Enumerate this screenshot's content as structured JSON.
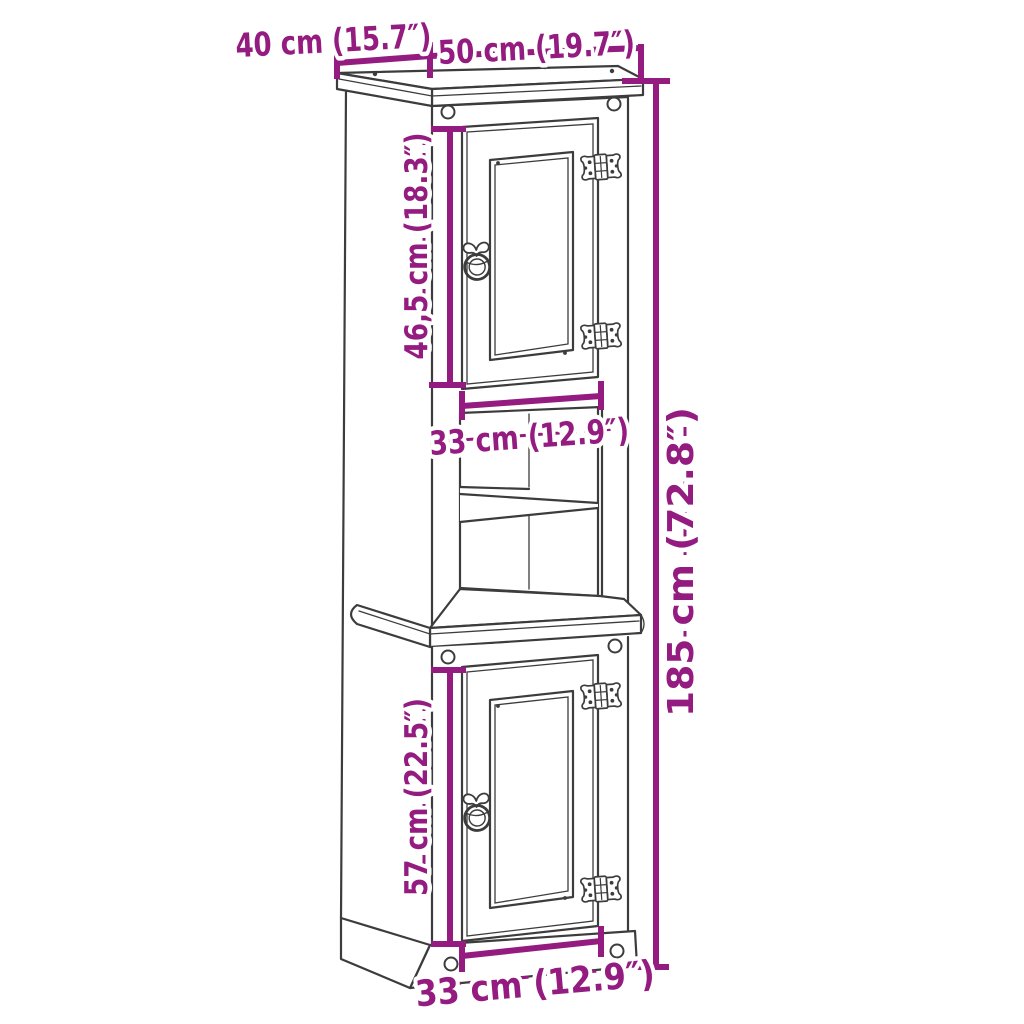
{
  "diagram": {
    "background_color": "#FFFFFF",
    "outline_color": "#3C3C3C",
    "dimension_color": "#941B80",
    "parts": {
      "hinge_icon": "decorative-colonial-hinge",
      "handle_icon": "ring-pull-handle",
      "peg_icon": "round-wood-peg"
    },
    "dimensions": {
      "top_depth": {
        "label": "40 cm (15.7″)",
        "cm": "40",
        "inches": "15.7"
      },
      "top_width": {
        "label": "50 cm (19.7″)",
        "cm": "50",
        "inches": "19.7"
      },
      "upper_door_height": {
        "label": "46,5 cm (18.3″)",
        "cm": "46,5",
        "inches": "18.3"
      },
      "middle_width": {
        "label": "33 cm (12.9″)",
        "cm": "33",
        "inches": "12.9"
      },
      "total_height": {
        "label": "185 cm (72.8″)",
        "cm": "185",
        "inches": "72.8"
      },
      "lower_door_height": {
        "label": "57 cm (22.5″)",
        "cm": "57",
        "inches": "22.5"
      },
      "bottom_width": {
        "label": "33 cm (12.9″)",
        "cm": "33",
        "inches": "12.9"
      }
    }
  }
}
